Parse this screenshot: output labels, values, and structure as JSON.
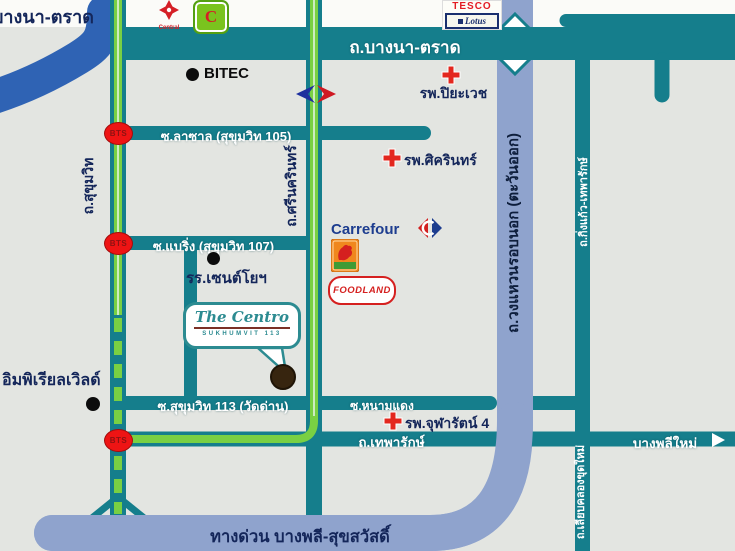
{
  "map": {
    "corner_label": "บางนา-ตราด",
    "roads": {
      "bangna_trad": "ถ.บางนา-ตราด",
      "sukhumvit": "ถ.สุขุมวิท",
      "srinakarin": "ถ.ศรีนครินทร์",
      "lasalle": "ซ.ลาซาล (สุขุมวิท 105)",
      "bearing": "ซ.แบริ่ง (สุขุมวิท 107)",
      "sukhumvit_113": "ซ.สุขุมวิท 113 (วัดด่าน)",
      "nam_daeng": "ซ.หนามแดง",
      "theparak": "ถ.เทพารักษ์",
      "bang_phli_mai": "บางพลีใหม่",
      "outer_ring": "ถ.วงแหวนรอบนอก (ตะวันออก)",
      "king_kaew": "ถ.กิ่งแก้ว-เทพารักษ์",
      "khlong_khut_mai": "ถ.เลียบคลองขุดใหม่",
      "expressway": "ทางด่วน บางพลี-สุขสวัสดิ์"
    },
    "places": {
      "bitec": "BITEC",
      "piyavate_hospital": "รพ.ปิยะเวช",
      "sikarin_hospital": "รพ.ศิครินทร์",
      "chularat_hospital": "รพ.จุฬารัตน์ 4",
      "st_joseph_school": "รร.เซนต์โยฯ",
      "imperial_world": "อิมพิเรียลเวิลด์"
    },
    "brands": {
      "central": "Central",
      "carrefour": "Carrefour",
      "foodland": "FOODLAND",
      "tesco": "TESCO",
      "lotus": "Lotus",
      "green_c": "C"
    },
    "transit": {
      "bts": "BTS"
    },
    "project": {
      "name": "The Centro",
      "subtitle": "SUKHUMVIT 113"
    },
    "colors": {
      "background": "#e3e5e1",
      "road_teal": "#157e8c",
      "road_green_stripe": "#79d043",
      "ring_road_blue": "#8fa3cd",
      "ramp_blue": "#2f63b4",
      "bts_red": "#ee1414",
      "hospital_cross_red": "#e3271e",
      "label_navy": "#14265a",
      "road_label_white": "#ffffff",
      "centro_teal": "#2c8b91",
      "marker_brown": "#37250f"
    }
  }
}
